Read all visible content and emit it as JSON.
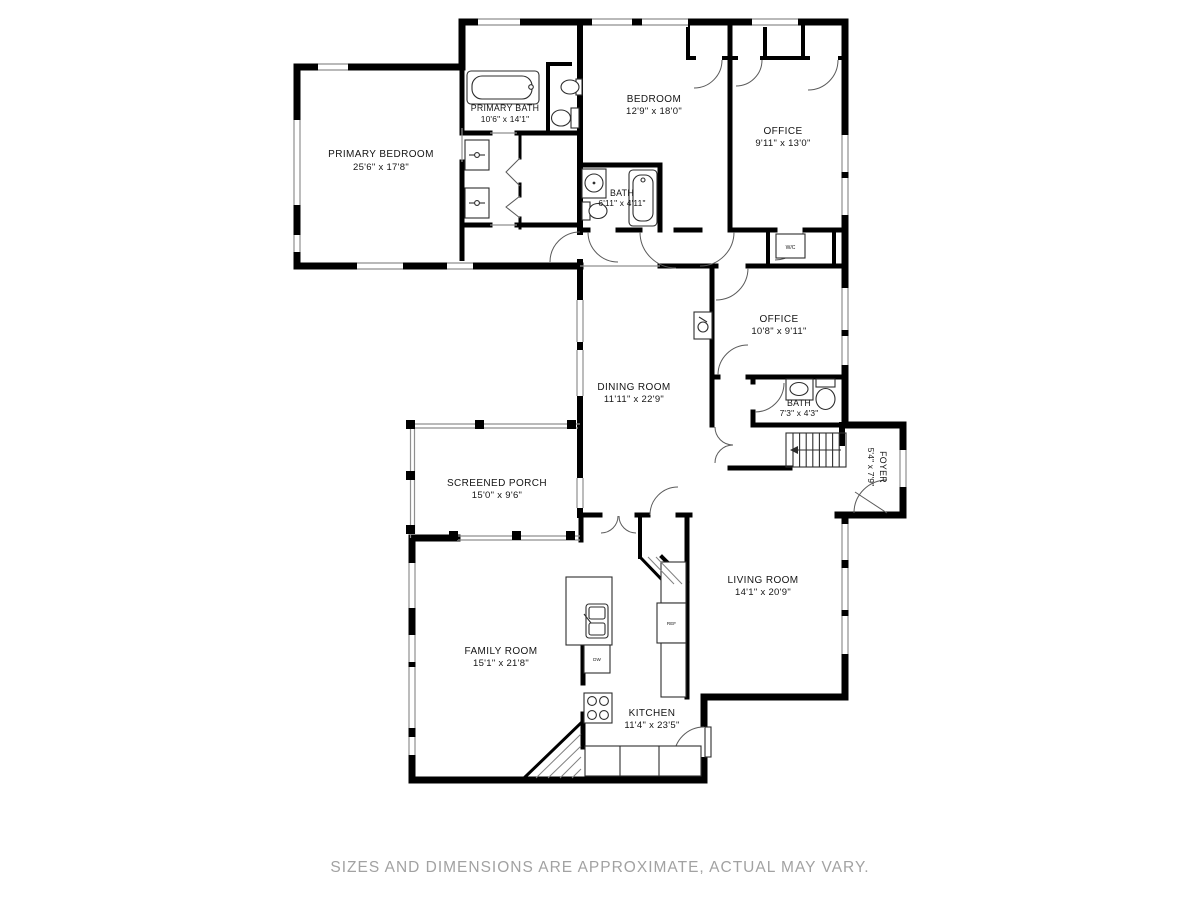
{
  "page": {
    "background": "#ffffff",
    "wall_color": "#000000",
    "window_line_color": "#8f8f8f",
    "footer_color": "#a2a2a2"
  },
  "footer": {
    "disclaimer": "SIZES AND DIMENSIONS ARE APPROXIMATE, ACTUAL MAY VARY."
  },
  "rooms": {
    "primary_bedroom": {
      "name": "PRIMARY BEDROOM",
      "dims": "25'6\" x 17'8\""
    },
    "primary_bath": {
      "name": "PRIMARY BATH",
      "dims": "10'6\" x 14'1\""
    },
    "bedroom": {
      "name": "BEDROOM",
      "dims": "12'9\" x 18'0\""
    },
    "office_top": {
      "name": "OFFICE",
      "dims": "9'11\" x 13'0\""
    },
    "hall_bath": {
      "name": "BATH",
      "dims": "6'11\" x 4'11\""
    },
    "office_mid": {
      "name": "OFFICE",
      "dims": "10'8\" x 9'11\""
    },
    "small_bath": {
      "name": "BATH",
      "dims": "7'3\" x 4'3\""
    },
    "dining_room": {
      "name": "DINING ROOM",
      "dims": "11'11\" x 22'9\""
    },
    "foyer": {
      "name": "FOYER",
      "dims": "5'4\" x 7'9\""
    },
    "screened_porch": {
      "name": "SCREENED PORCH",
      "dims": "15'0\" x 9'6\""
    },
    "living_room": {
      "name": "LIVING ROOM",
      "dims": "14'1\" x 20'9\""
    },
    "family_room": {
      "name": "FAMILY ROOM",
      "dims": "15'1\" x 21'8\""
    },
    "kitchen": {
      "name": "KITCHEN",
      "dims": "11'4\" x 23'5\""
    }
  },
  "fixtures": {
    "wc": "W/C",
    "ref": "REF",
    "dw": "DW"
  }
}
